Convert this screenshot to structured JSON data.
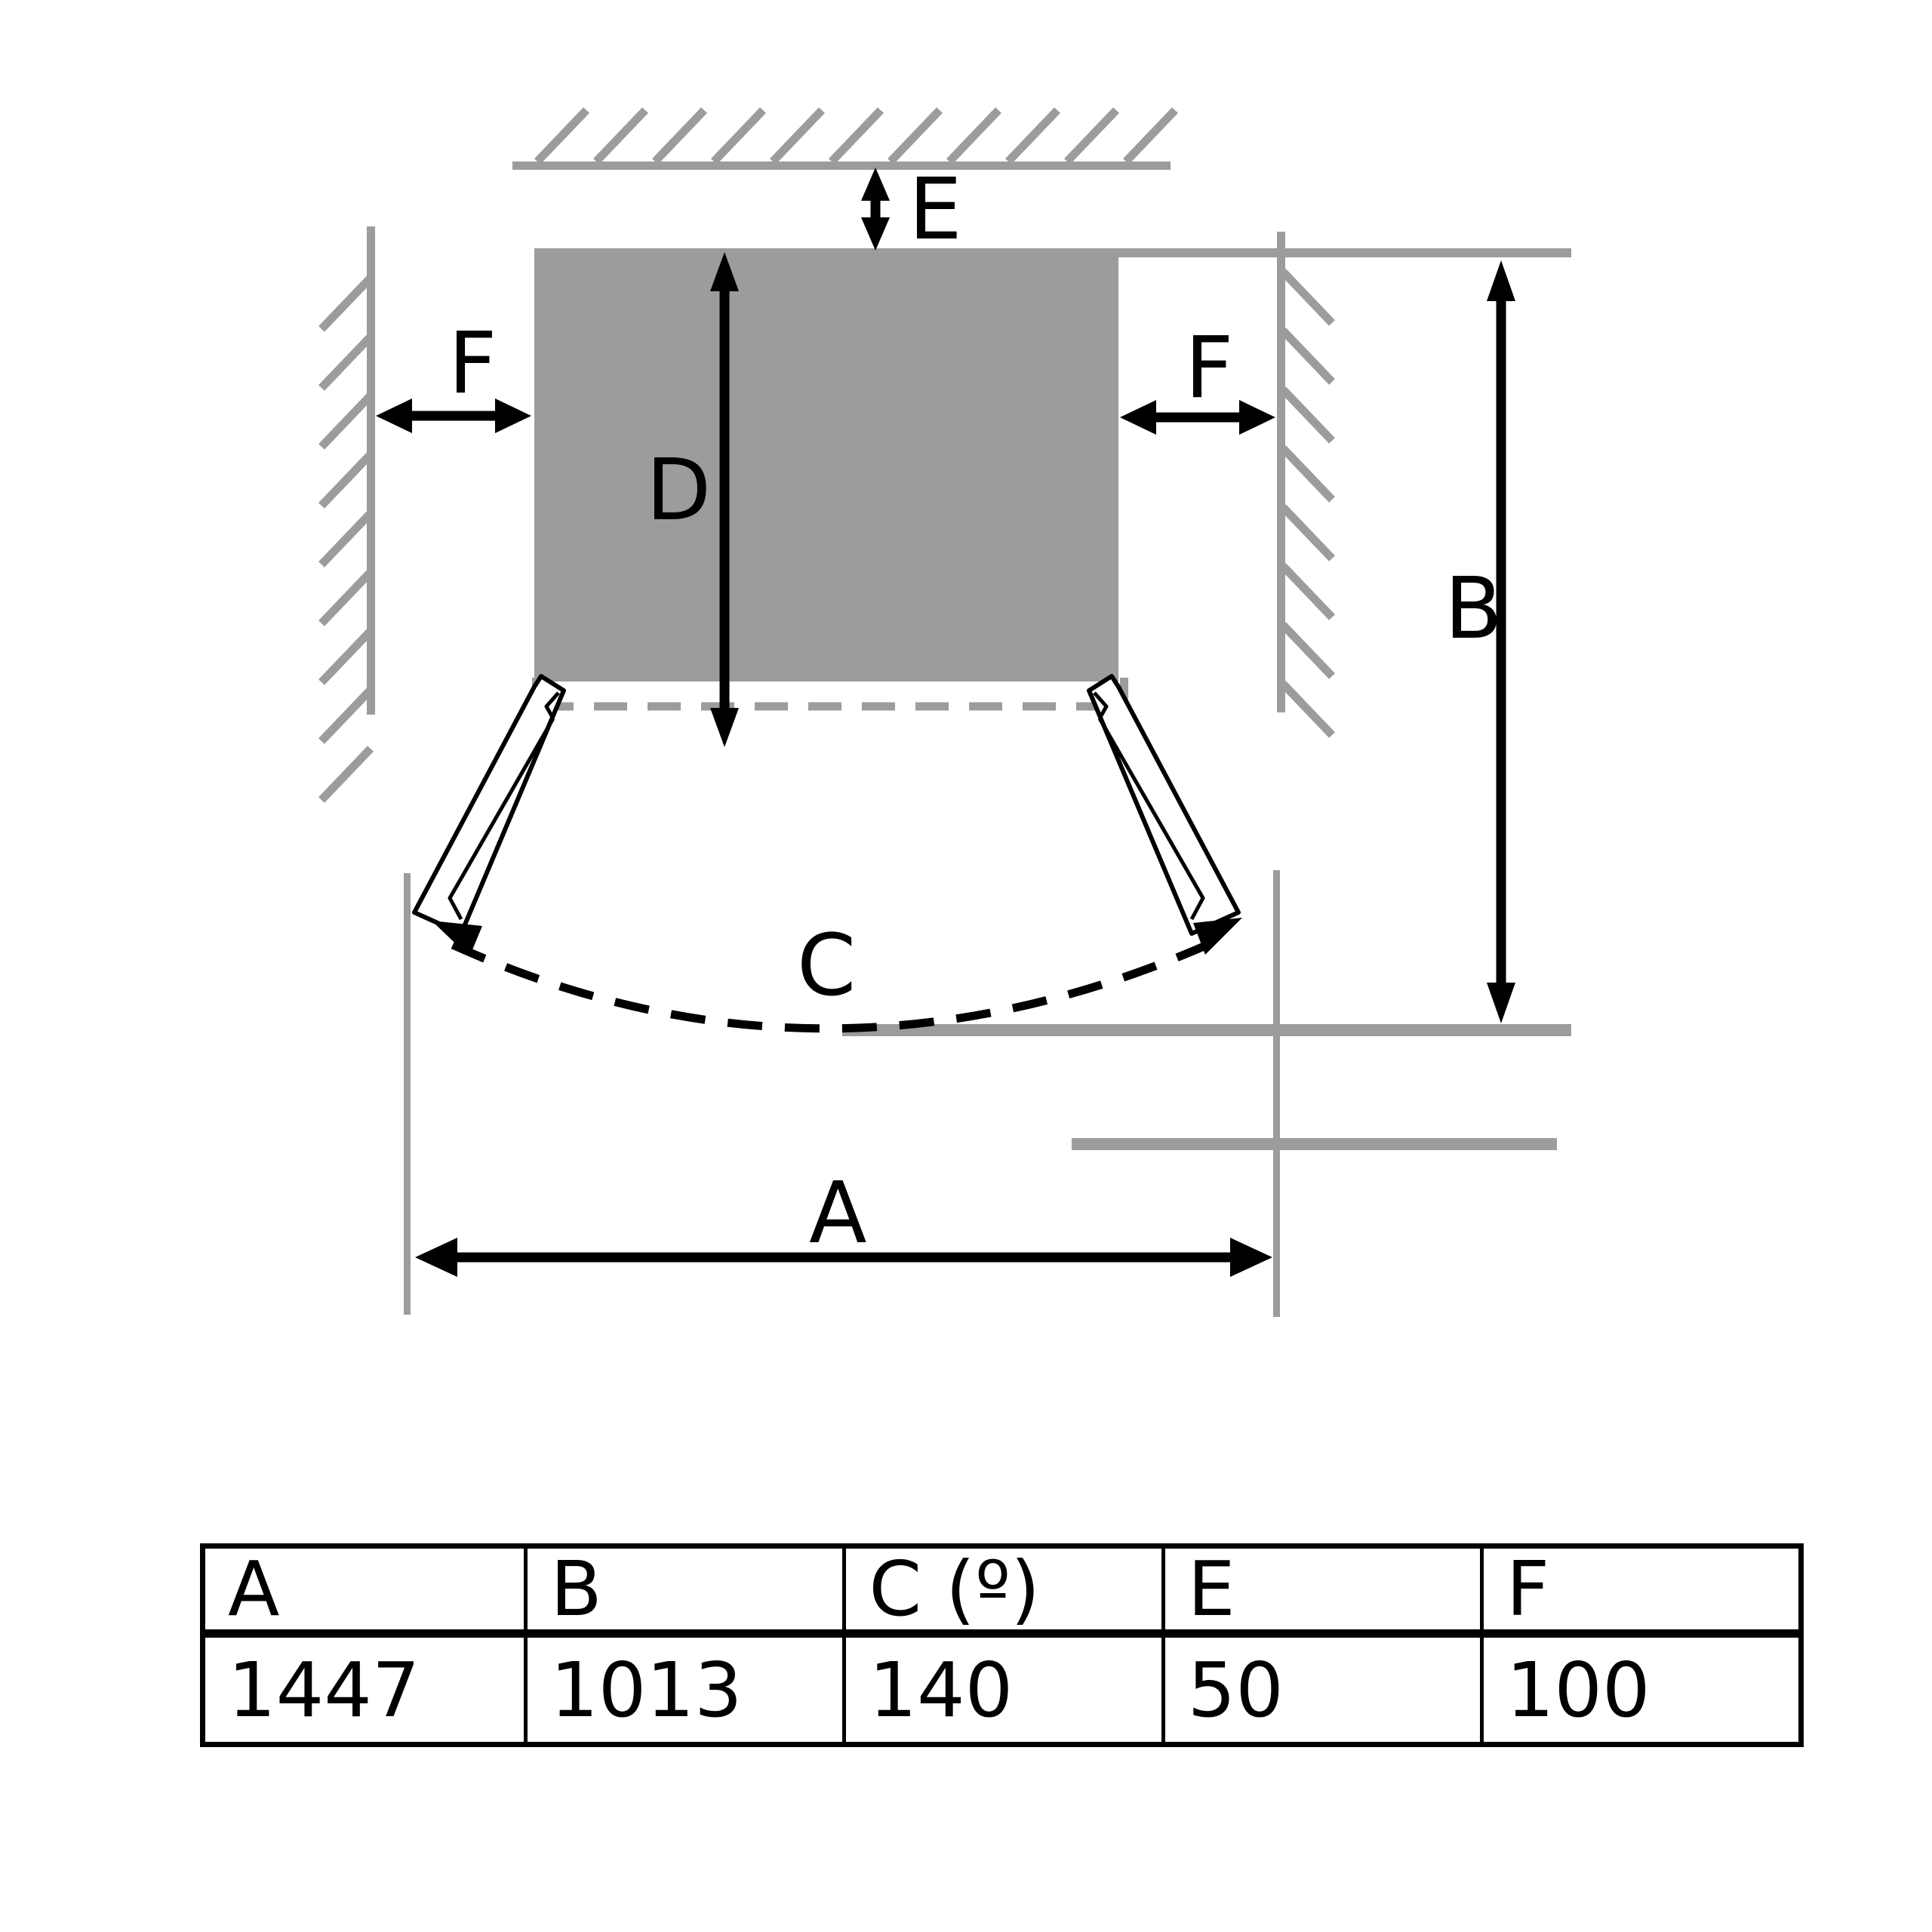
{
  "colors": {
    "gray": "#9c9c9c",
    "black": "#000000",
    "background": "#ffffff"
  },
  "diagram": {
    "title": "appliance-installation-clearance-top-view",
    "labels": {
      "a": "A",
      "b": "B",
      "c": "C",
      "d": "D",
      "e": "E",
      "f": "F"
    }
  },
  "table": {
    "headers": [
      "A",
      "B",
      "C (º)",
      "E",
      "F"
    ],
    "values": [
      "1447",
      "1013",
      "140",
      "50",
      "100"
    ]
  }
}
